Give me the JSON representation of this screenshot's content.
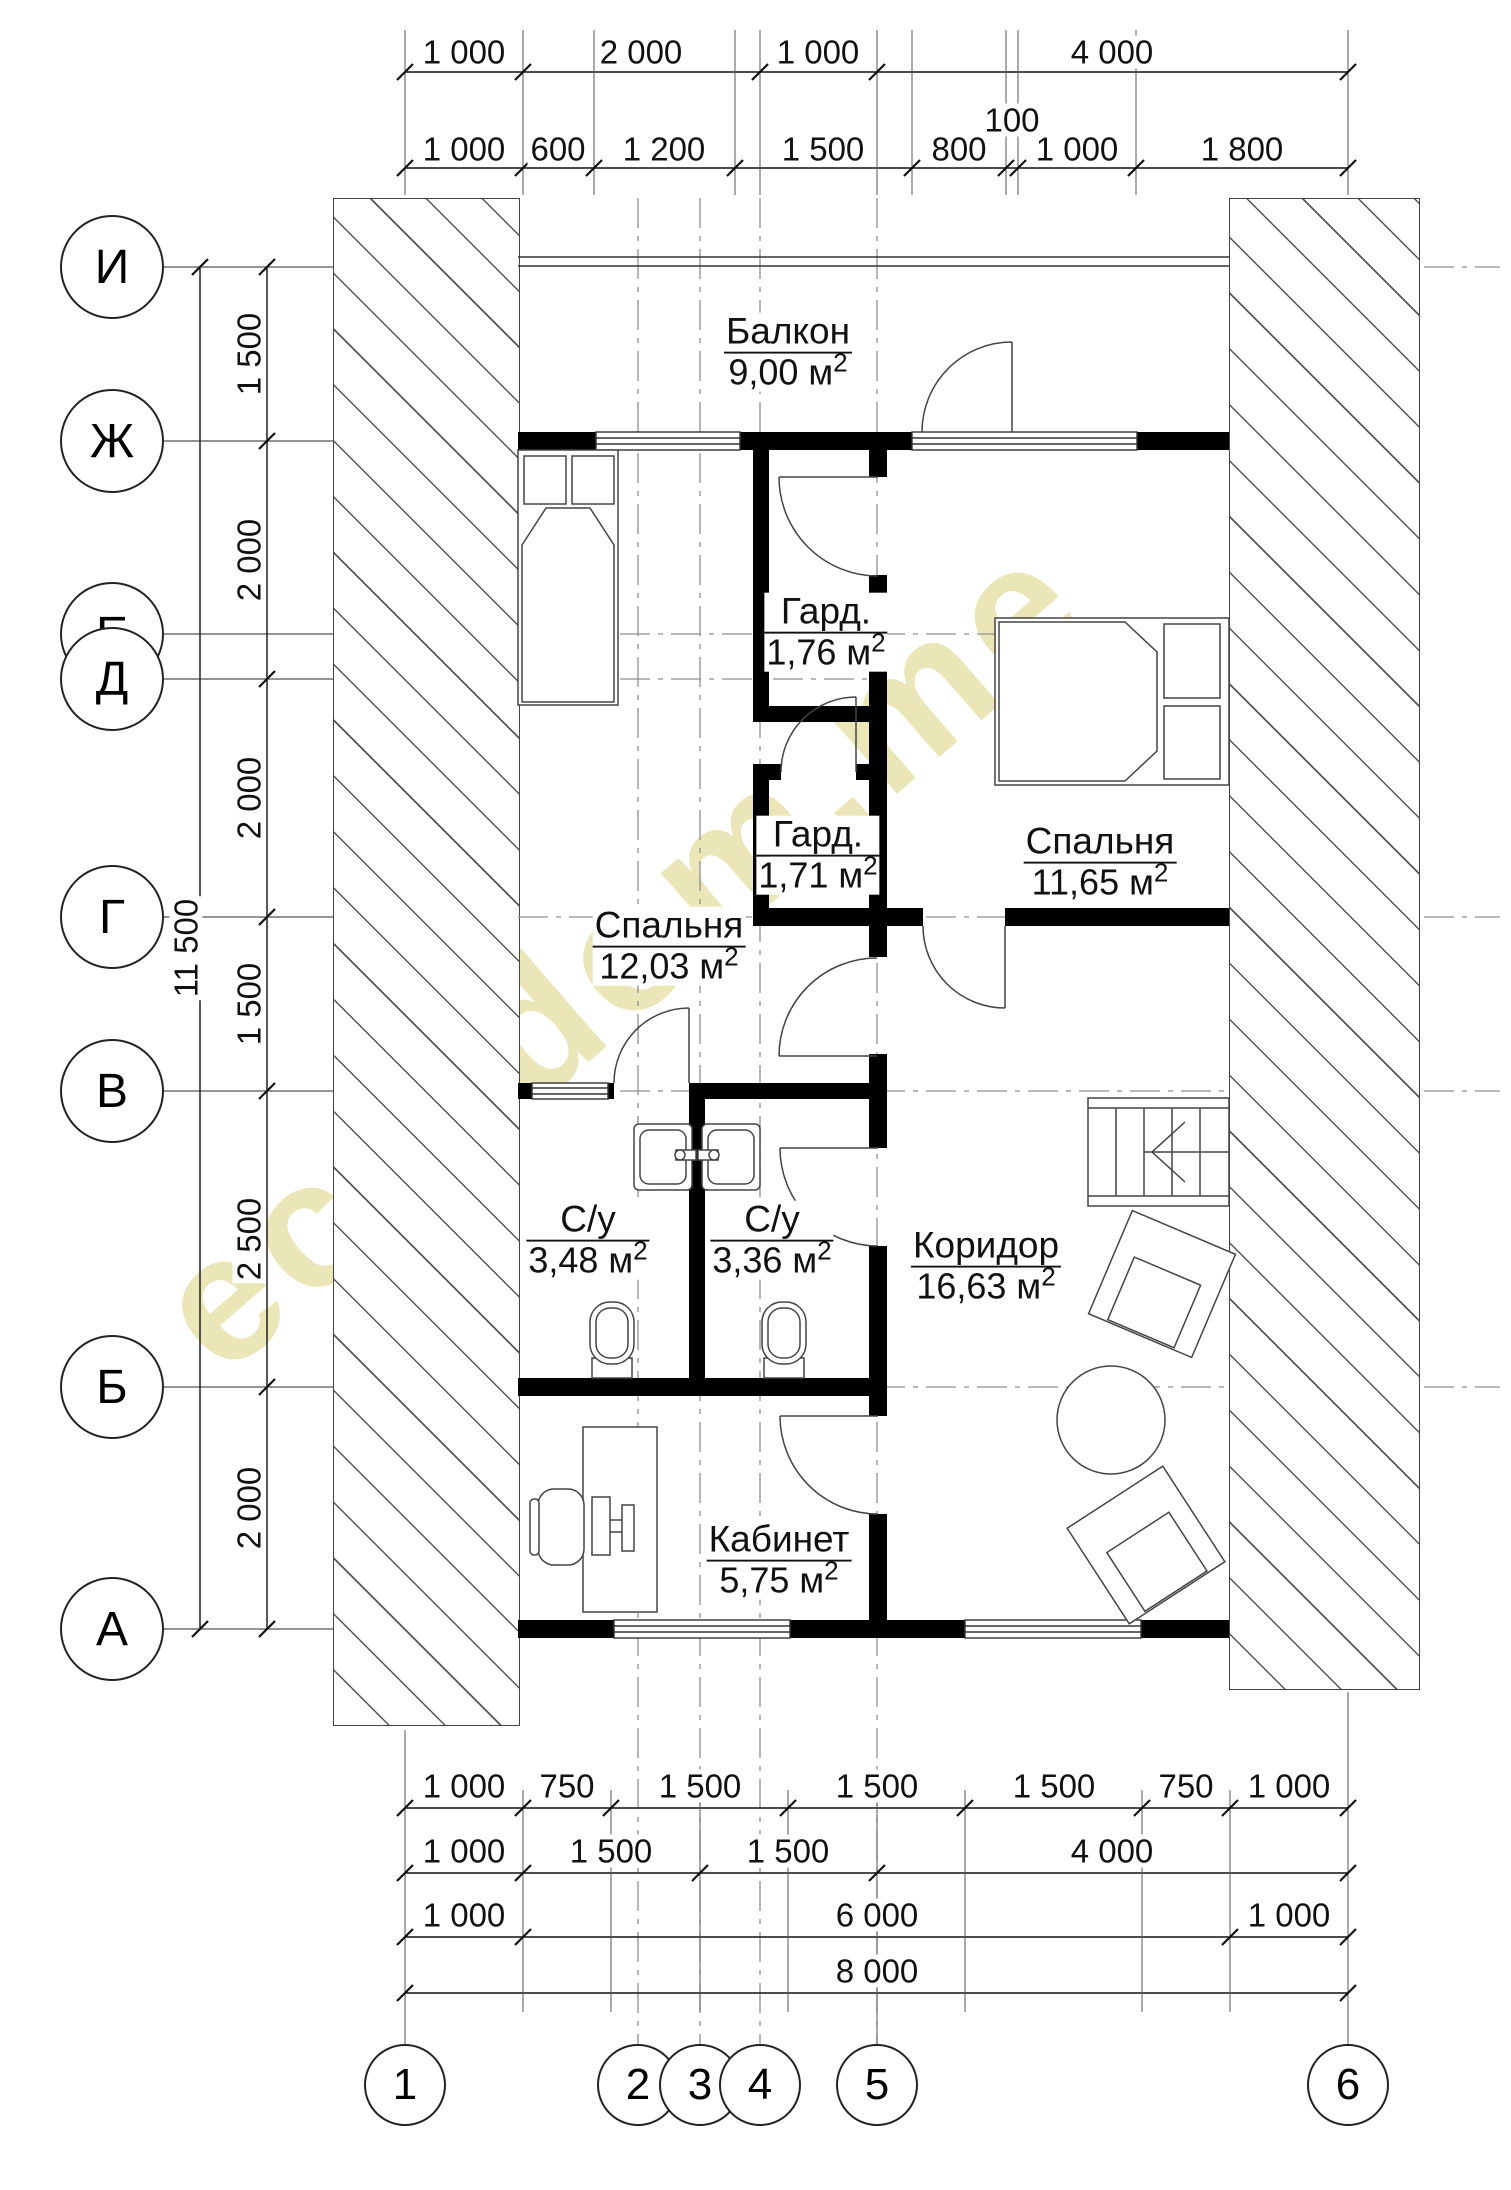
{
  "watermark": "eco-dom.me",
  "rooms": [
    {
      "name": "Балкон",
      "area": "9,00 м",
      "sup": "2"
    },
    {
      "name": "Гард.",
      "area": "1,76 м",
      "sup": "2"
    },
    {
      "name": "Спальня",
      "area": "11,65 м",
      "sup": "2"
    },
    {
      "name": "Гард.",
      "area": "1,71 м",
      "sup": "2"
    },
    {
      "name": "Спальня",
      "area": "12,03 м",
      "sup": "2"
    },
    {
      "name": "С/у",
      "area": "3,48 м",
      "sup": "2"
    },
    {
      "name": "С/у",
      "area": "3,36 м",
      "sup": "2"
    },
    {
      "name": "Коридор",
      "area": "16,63 м",
      "sup": "2"
    },
    {
      "name": "Кабинет",
      "area": "5,75 м",
      "sup": "2"
    }
  ],
  "row_axes": [
    "И",
    "Ж",
    "Е",
    "Д",
    "Г",
    "В",
    "Б",
    "А"
  ],
  "col_axes": [
    "1",
    "2",
    "3",
    "4",
    "5",
    "6"
  ],
  "dims": {
    "top1": [
      "1 000",
      "2 000",
      "1 000",
      "4 000"
    ],
    "top2": [
      "1 000",
      "600",
      "1 200",
      "1 500",
      "800",
      "1 000",
      "1 800"
    ],
    "top_small": "100",
    "left": [
      "1 500",
      "2 000",
      "2 000",
      "1 500",
      "2 500",
      "2 000"
    ],
    "left_total": "11 500",
    "b1": [
      "1 000",
      "750",
      "1 500",
      "1 500",
      "1 500",
      "750",
      "1 000"
    ],
    "b2": [
      "1 000",
      "1 500",
      "1 500",
      "4 000"
    ],
    "b3": [
      "1 000",
      "6 000",
      "1 000"
    ],
    "b4": [
      "8 000"
    ]
  }
}
